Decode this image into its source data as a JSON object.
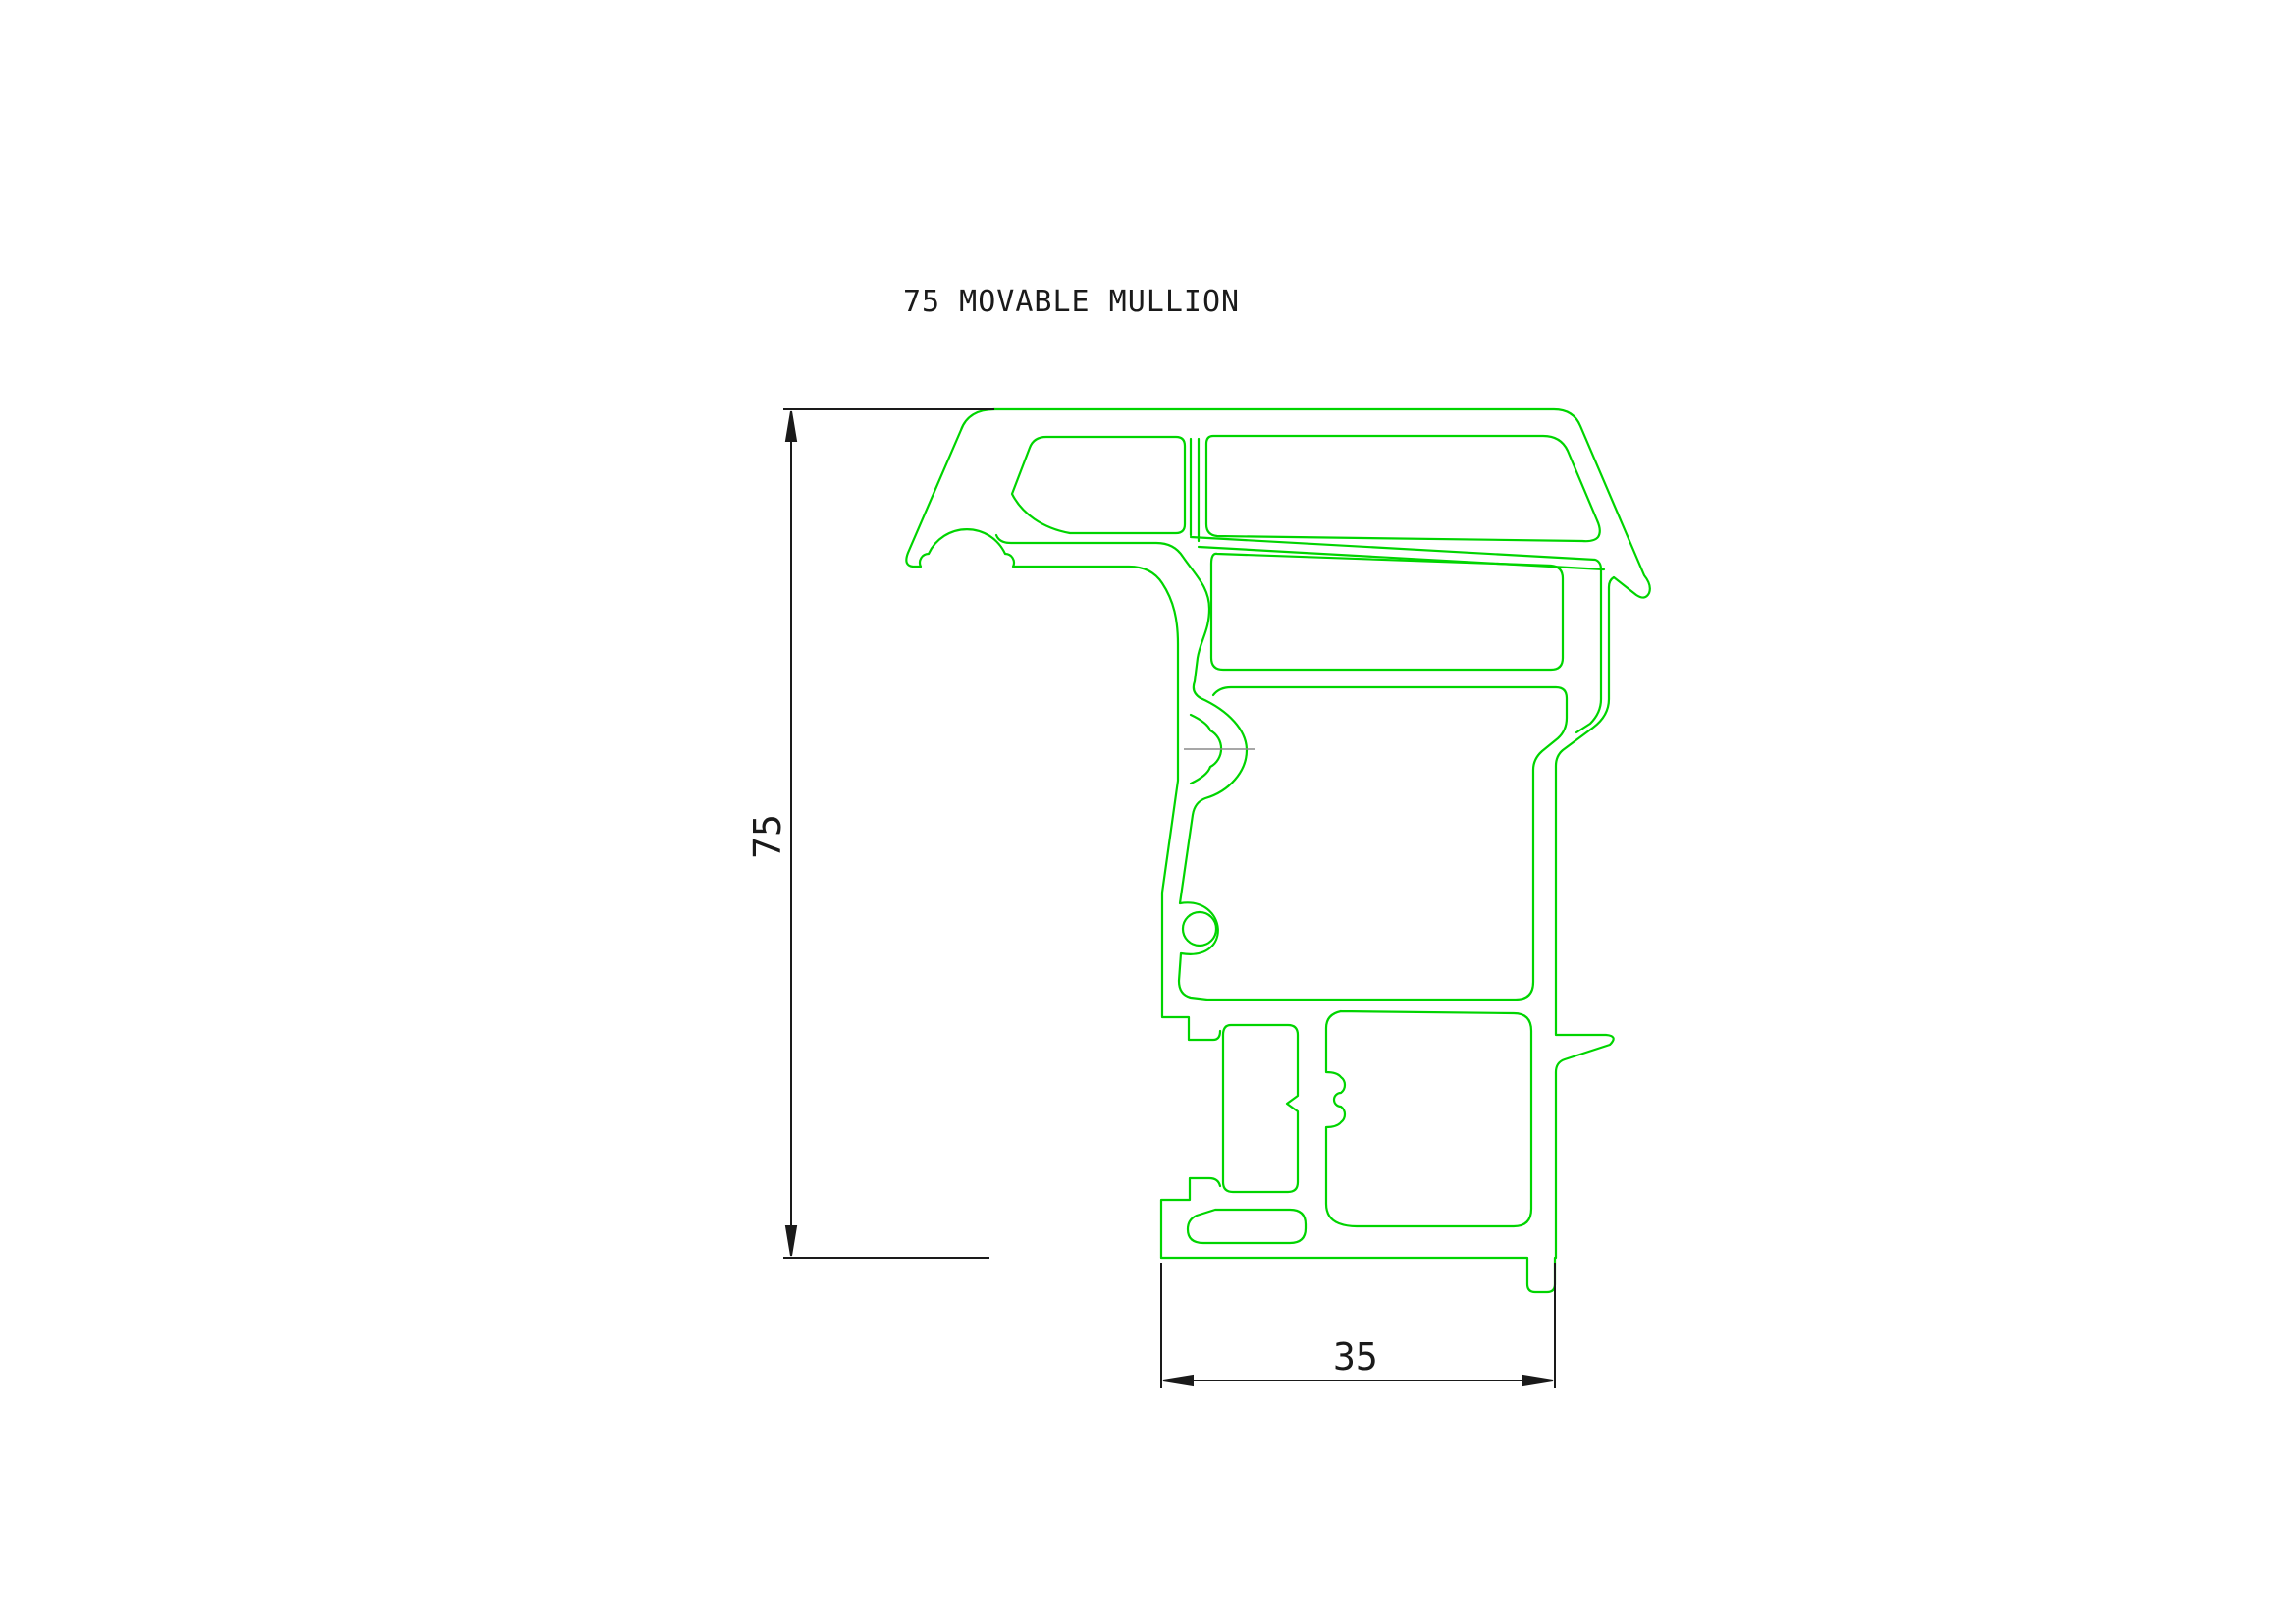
{
  "title": {
    "text": "75 MOVABLE MULLION"
  },
  "dimensions": {
    "height": {
      "value": "75"
    },
    "width": {
      "value": "35"
    }
  },
  "colors": {
    "profile_line": "#00d400",
    "dimension_line": "#1a1a1a",
    "centerline": "#8a8a8a",
    "background": "#ffffff"
  }
}
